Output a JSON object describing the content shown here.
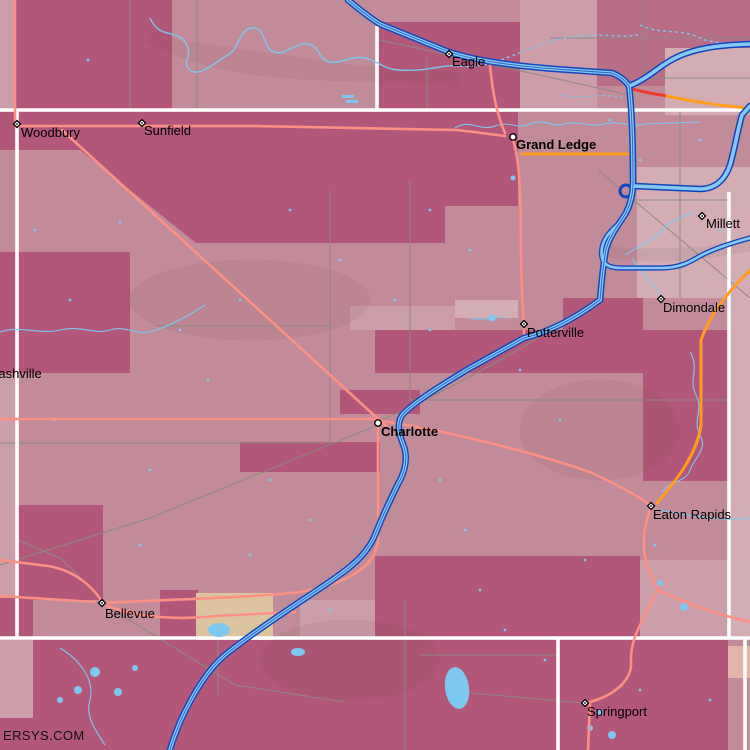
{
  "map": {
    "watermark": "ERSYS.COM",
    "colors": {
      "region_medium": "#c28b99",
      "region_dark": "#b3577a",
      "region_dark2": "#b96e87",
      "region_light": "#cc9ea9",
      "region_pale": "#d4acb3",
      "region_tan": "#dcc49e",
      "region_paletan": "#e2b4aa",
      "water": "#7cc8ef",
      "hwy_casing": "#1545bd",
      "hwy_center": "#86c9f2",
      "road_salmon": "#fb9184",
      "road_orange": "#ff9d1e",
      "road_red": "#f23b2a",
      "road_gray": "#8a8a80",
      "boundary_white": "#ffffff",
      "label": "#000000"
    },
    "places": [
      {
        "name": "Eagle",
        "x": 449,
        "y": 54,
        "marker": "diamond",
        "bold": false,
        "label_dx": 3,
        "label_dy": 12
      },
      {
        "name": "Woodbury",
        "x": 17,
        "y": 124,
        "marker": "diamond",
        "bold": false,
        "label_dx": 4,
        "label_dy": 13
      },
      {
        "name": "Sunfield",
        "x": 142,
        "y": 123,
        "marker": "diamond",
        "bold": false,
        "label_dx": 2,
        "label_dy": 12
      },
      {
        "name": "Grand Ledge",
        "x": 513,
        "y": 137,
        "marker": "circle",
        "bold": true,
        "label_dx": 3,
        "label_dy": 12
      },
      {
        "name": "Millett",
        "x": 702,
        "y": 216,
        "marker": "diamond",
        "bold": false,
        "label_dx": 4,
        "label_dy": 12
      },
      {
        "name": "Dimondale",
        "x": 661,
        "y": 299,
        "marker": "diamond",
        "bold": false,
        "label_dx": 2,
        "label_dy": 13
      },
      {
        "name": "Potterville",
        "x": 524,
        "y": 324,
        "marker": "diamond",
        "bold": false,
        "label_dx": 3,
        "label_dy": 13
      },
      {
        "name": "Nashville",
        "x": -11,
        "y": 365,
        "marker": "none",
        "bold": false,
        "label_dx": 0,
        "label_dy": 13
      },
      {
        "name": "Charlotte",
        "x": 378,
        "y": 423,
        "marker": "circle",
        "bold": true,
        "label_dx": 3,
        "label_dy": 13
      },
      {
        "name": "Eaton Rapids",
        "x": 651,
        "y": 506,
        "marker": "diamond",
        "bold": false,
        "label_dx": 2,
        "label_dy": 13
      },
      {
        "name": "Bellevue",
        "x": 102,
        "y": 603,
        "marker": "diamond",
        "bold": false,
        "label_dx": 3,
        "label_dy": 15
      },
      {
        "name": "Springport",
        "x": 585,
        "y": 703,
        "marker": "diamond",
        "bold": false,
        "label_dx": 2,
        "label_dy": 13
      }
    ]
  }
}
